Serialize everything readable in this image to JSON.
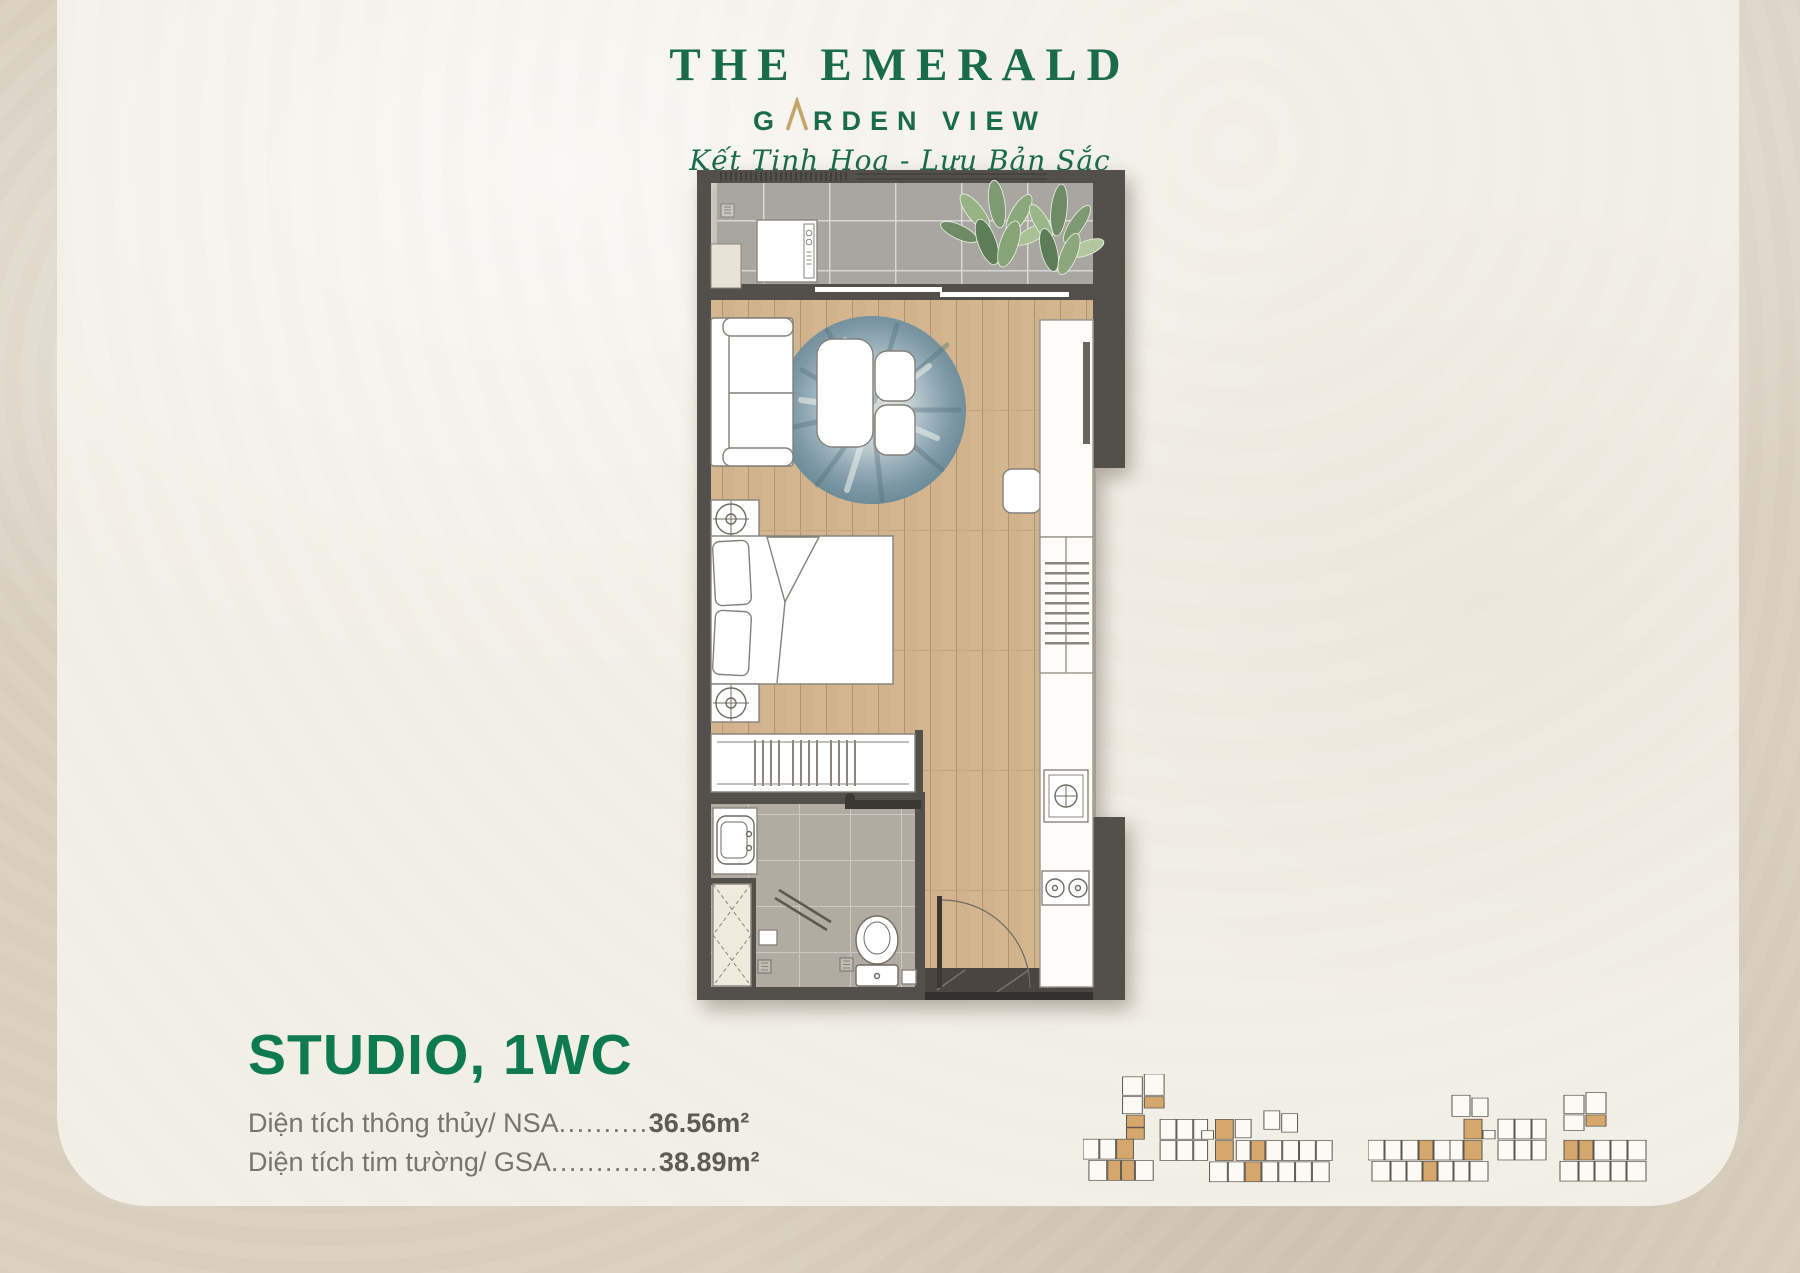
{
  "brand": {
    "title": "THE EMERALD",
    "subtitle_g": "G",
    "subtitle_rest": "RDEN VIEW",
    "tagline": "Kết Tinh Hoa - Lưu Bản Sắc",
    "green": "#1a6b4c",
    "gold": "#c7a469"
  },
  "unit_info": {
    "title": "STUDIO, 1WC",
    "title_color": "#0e7a50",
    "areas": [
      {
        "label": "Diện tích thông thủy/ NSA",
        "dots": "..........",
        "value": "36.56m²"
      },
      {
        "label": "Diện tích tim tường/ GSA",
        "dots": "............",
        "value": "38.89m²"
      }
    ]
  },
  "floor_plan": {
    "fixtures": [
      "washing-machine",
      "balcony-plant",
      "sliding-door",
      "sofa",
      "round-rug",
      "coffee-table",
      "chair",
      "stool",
      "tv-cabinet",
      "shelf-unit",
      "nightstand-lamp",
      "double-bed",
      "wardrobe",
      "kitchen-sink",
      "stove",
      "bathroom-sink",
      "linen-closet",
      "shower",
      "toilet",
      "floor-drain",
      "entry-door"
    ],
    "highlight_color": "#d5a76c"
  },
  "key_plans": [
    {
      "name": "tower-block-1",
      "width": 265,
      "height": 158,
      "units": [
        [
          40,
          4,
          20,
          26,
          0
        ],
        [
          62,
          0,
          20,
          30,
          0
        ],
        [
          62,
          32,
          20,
          16,
          1
        ],
        [
          40,
          32,
          20,
          24,
          0
        ],
        [
          44,
          58,
          18,
          17,
          1
        ],
        [
          44,
          76,
          18,
          16,
          1
        ],
        [
          0,
          92,
          16,
          28,
          0
        ],
        [
          17,
          92,
          16,
          28,
          0
        ],
        [
          34,
          92,
          17,
          28,
          1
        ],
        [
          6,
          122,
          18,
          28,
          0
        ],
        [
          25,
          122,
          13,
          28,
          1
        ],
        [
          39,
          122,
          13,
          28,
          1
        ],
        [
          53,
          122,
          18,
          28,
          0
        ],
        [
          78,
          64,
          16,
          28,
          0
        ],
        [
          95,
          64,
          16,
          28,
          0
        ],
        [
          112,
          64,
          14,
          28,
          0
        ],
        [
          120,
          80,
          12,
          12,
          0
        ],
        [
          134,
          64,
          18,
          28,
          1
        ],
        [
          134,
          94,
          18,
          28,
          1
        ],
        [
          78,
          94,
          16,
          28,
          0
        ],
        [
          95,
          94,
          16,
          28,
          0
        ],
        [
          112,
          94,
          14,
          28,
          0
        ],
        [
          154,
          64,
          16,
          26,
          0
        ],
        [
          183,
          52,
          16,
          26,
          0
        ],
        [
          201,
          56,
          16,
          26,
          0
        ],
        [
          155,
          94,
          14,
          28,
          0
        ],
        [
          170,
          94,
          14,
          28,
          1
        ],
        [
          185,
          94,
          16,
          28,
          0
        ],
        [
          202,
          94,
          16,
          28,
          0
        ],
        [
          219,
          94,
          16,
          28,
          0
        ],
        [
          236,
          94,
          16,
          28,
          0
        ],
        [
          128,
          124,
          18,
          28,
          0
        ],
        [
          147,
          124,
          16,
          28,
          0
        ],
        [
          164,
          124,
          16,
          28,
          1
        ],
        [
          181,
          124,
          16,
          28,
          0
        ],
        [
          198,
          124,
          16,
          28,
          0
        ],
        [
          215,
          124,
          16,
          28,
          0
        ],
        [
          232,
          124,
          17,
          28,
          0
        ]
      ]
    },
    {
      "name": "tower-block-2",
      "width": 300,
      "height": 145,
      "units": [
        [
          84,
          16,
          18,
          30,
          0
        ],
        [
          104,
          20,
          16,
          26,
          0
        ],
        [
          196,
          16,
          20,
          26,
          0
        ],
        [
          218,
          12,
          20,
          30,
          0
        ],
        [
          218,
          44,
          20,
          16,
          1
        ],
        [
          196,
          44,
          20,
          22,
          0
        ],
        [
          96,
          50,
          18,
          28,
          1
        ],
        [
          96,
          80,
          18,
          28,
          1
        ],
        [
          115,
          66,
          12,
          12,
          0
        ],
        [
          130,
          50,
          16,
          28,
          0
        ],
        [
          147,
          50,
          16,
          28,
          0
        ],
        [
          164,
          50,
          14,
          28,
          0
        ],
        [
          0,
          80,
          16,
          28,
          0
        ],
        [
          17,
          80,
          16,
          28,
          0
        ],
        [
          34,
          80,
          16,
          28,
          0
        ],
        [
          51,
          80,
          14,
          28,
          1
        ],
        [
          66,
          80,
          16,
          28,
          0
        ],
        [
          82,
          80,
          13,
          28,
          0
        ],
        [
          130,
          80,
          16,
          28,
          0
        ],
        [
          147,
          80,
          16,
          28,
          0
        ],
        [
          164,
          80,
          14,
          28,
          0
        ],
        [
          196,
          80,
          14,
          28,
          1
        ],
        [
          211,
          80,
          14,
          28,
          1
        ],
        [
          226,
          80,
          16,
          28,
          0
        ],
        [
          243,
          80,
          16,
          28,
          0
        ],
        [
          260,
          80,
          18,
          28,
          0
        ],
        [
          4,
          110,
          18,
          28,
          0
        ],
        [
          23,
          110,
          15,
          28,
          0
        ],
        [
          39,
          110,
          15,
          28,
          0
        ],
        [
          55,
          110,
          14,
          28,
          1
        ],
        [
          70,
          110,
          15,
          28,
          0
        ],
        [
          86,
          110,
          15,
          28,
          0
        ],
        [
          102,
          110,
          18,
          28,
          0
        ],
        [
          192,
          110,
          18,
          28,
          0
        ],
        [
          211,
          110,
          15,
          28,
          0
        ],
        [
          227,
          110,
          15,
          28,
          0
        ],
        [
          243,
          110,
          15,
          28,
          0
        ],
        [
          259,
          110,
          19,
          28,
          0
        ]
      ]
    }
  ]
}
